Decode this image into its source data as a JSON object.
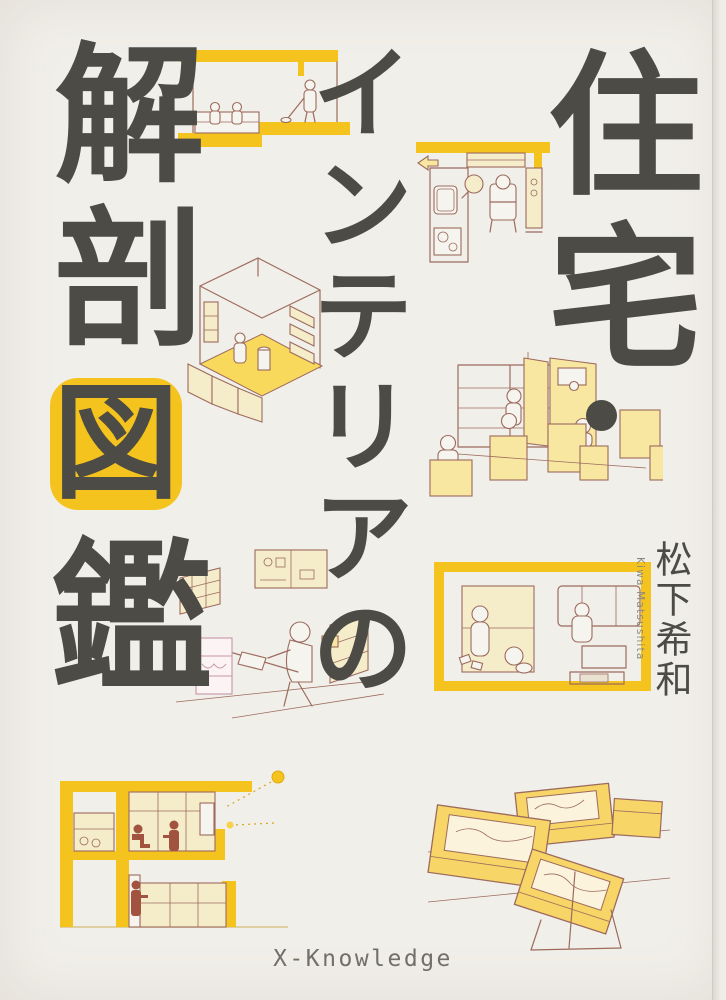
{
  "cover": {
    "title": {
      "full": "住宅・インテリアの解剖図鑑",
      "right_column": "住宅",
      "interpunct": "・",
      "middle_column": "インテリアの",
      "left_column_top": "解剖",
      "left_column_boxed": "図",
      "left_column_bottom": "鑑"
    },
    "author": {
      "name_ja": "松下希和",
      "name_romaji": "Kiwa Matsushita"
    },
    "publisher": {
      "name": "X-Knowledge"
    },
    "colors": {
      "background": "#f1efe9",
      "ink": "#4c4b45",
      "accent_yellow": "#f5c31d",
      "pale_yellow": "#f8e7a0",
      "cream": "#f5ecca",
      "line_brown": "#9c6b5e",
      "figure_maroon": "#a2533f",
      "pink": "#c795a8"
    },
    "illustrations": [
      {
        "name": "sunken-living-section-illustration"
      },
      {
        "name": "kitchen-plan-illustration"
      },
      {
        "name": "isometric-room-illustration"
      },
      {
        "name": "wardrobe-closet-illustration"
      },
      {
        "name": "workspace-desk-illustration"
      },
      {
        "name": "bedroom-plan-framed-illustration"
      },
      {
        "name": "house-cross-section-illustration"
      },
      {
        "name": "storage-boxes-illustration"
      }
    ]
  }
}
